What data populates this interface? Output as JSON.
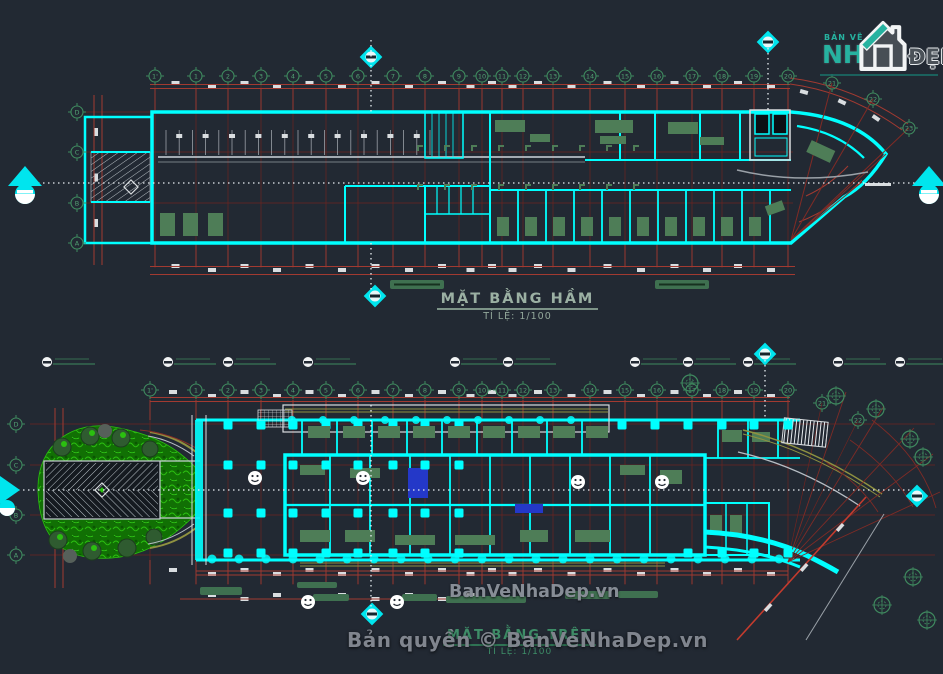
{
  "canvas": {
    "width": 943,
    "height": 674,
    "background_color": "#222933"
  },
  "branding": {
    "logo_small_text": "BẢN VẼ",
    "logo_main_text": "NH",
    "logo_suffix_text": "ĐẸP",
    "logo_teal": "#26B2A0",
    "center_watermark": "BanVeNhaDep.vn",
    "footer_copyright": "Bản quyền © BanVeNhaDep.vn"
  },
  "plans": [
    {
      "title": "MẶT BẰNG HẦM",
      "scale_label": "TỈ LỆ: 1/100",
      "grid_columns": [
        "1'",
        "1",
        "2",
        "3",
        "4",
        "5",
        "6",
        "7",
        "8",
        "9",
        "10",
        "11",
        "12",
        "13",
        "14",
        "15",
        "16",
        "17",
        "18",
        "19",
        "20",
        "21",
        "22",
        "23"
      ],
      "grid_rows": [
        "D",
        "C",
        "B",
        "A"
      ]
    },
    {
      "title": "MẶT BẰNG TRỆT",
      "scale_label": "TỈ LỆ: 1/100",
      "grid_columns": [
        "1'",
        "1",
        "2",
        "3",
        "4",
        "5",
        "6",
        "7",
        "8",
        "9",
        "10",
        "11",
        "12",
        "13",
        "14",
        "15",
        "16",
        "17",
        "18",
        "19",
        "20",
        "21",
        "22"
      ],
      "grid_rows": [
        "D",
        "C",
        "B",
        "A"
      ]
    }
  ],
  "palette": {
    "wall_cyan": "#00FFFF",
    "grid_red": "#7E2B26",
    "dim_red": "#A23A31",
    "accent_red": "#C23B2E",
    "furniture_green": "#4E7D57",
    "marker_green": "#4E9C6E",
    "garden_green": "#2BBF10",
    "khaki": "#8F9140",
    "blue": "#2438C8",
    "white": "#D9DDE0",
    "title_basement_color": "#9BB0A3",
    "title_ground_color": "#3E8E68",
    "watermark_gray": "#878D96"
  }
}
